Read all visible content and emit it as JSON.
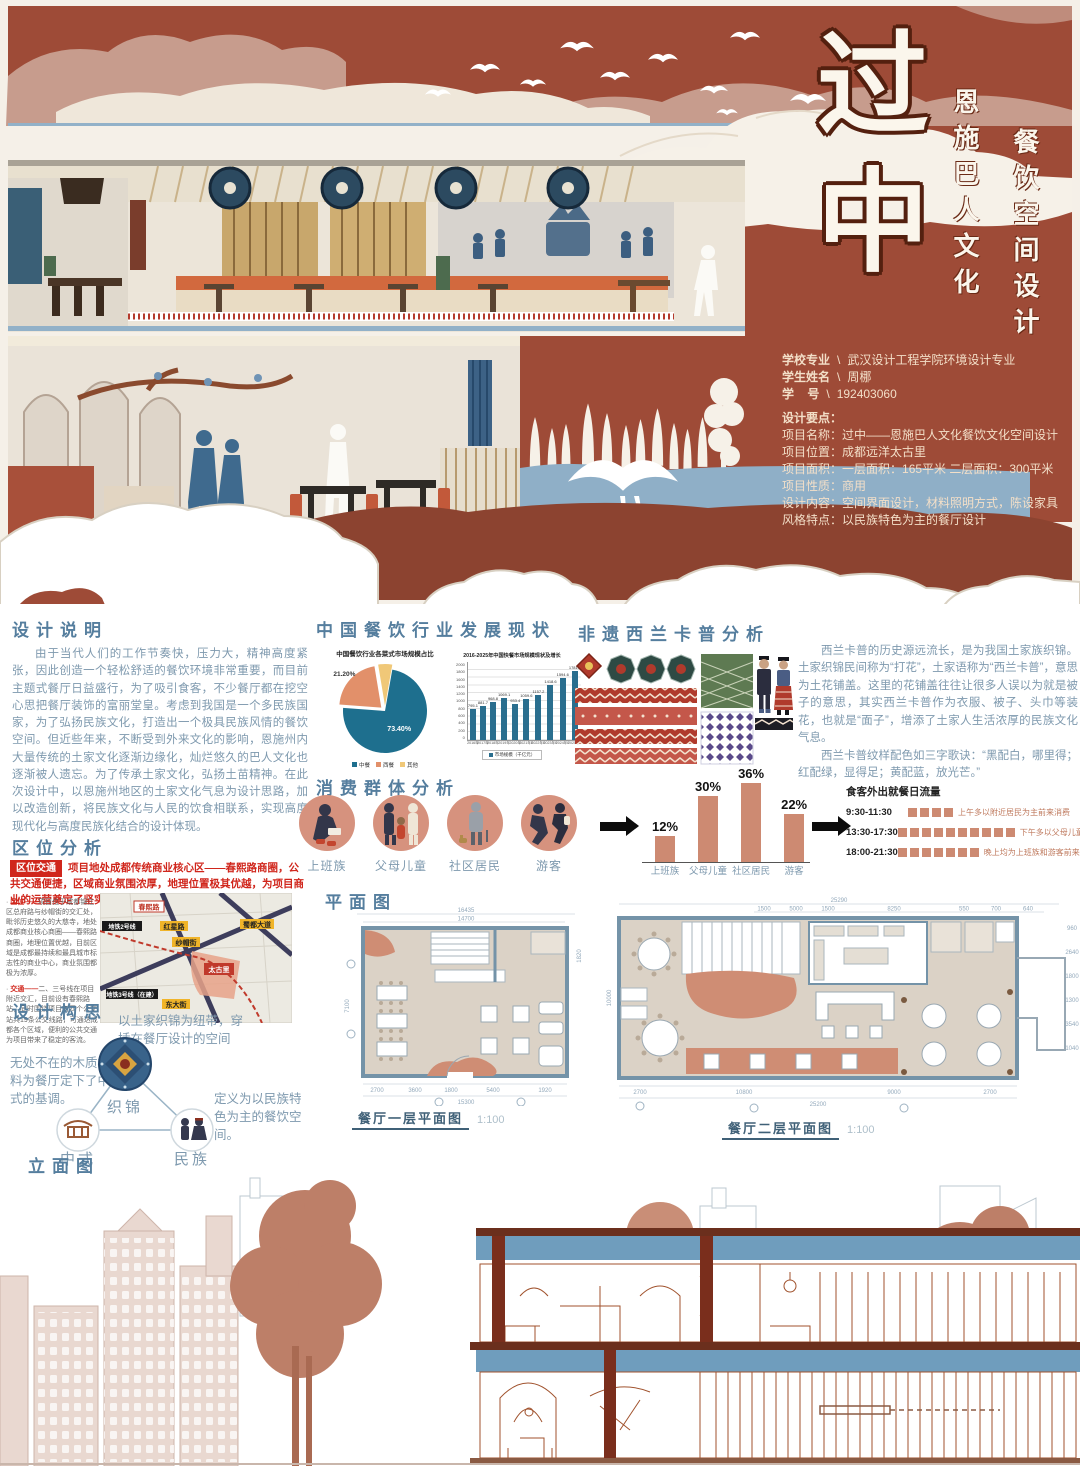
{
  "hero": {
    "title_main_char1": "过",
    "title_main_char2": "中",
    "title_col_1": "恩施巴人文化",
    "title_col_2": "餐饮空间设计",
    "info_sep": "\\",
    "info_rows": [
      {
        "label": "学校专业",
        "value": "武汉设计工程学院环境设计专业"
      },
      {
        "label": "学生姓名",
        "value": "周梛"
      },
      {
        "label": "学    号",
        "value": "192403060"
      }
    ],
    "points_title": "设计要点：",
    "points": [
      {
        "label": "项目名称：",
        "value": "过中——恩施巴人文化餐饮文化空间设计"
      },
      {
        "label": "项目位置：",
        "value": "成都远洋太古里"
      },
      {
        "label": "项目面积：",
        "value": "一层面积：165平米  二层面积：300平米"
      },
      {
        "label": "项目性质：",
        "value": "商用"
      },
      {
        "label": "设计内容：",
        "value": "空间界面设计，材料照明方式，陈设家具"
      },
      {
        "label": "风格特点：",
        "value": "以民族特色为主的餐厅设计"
      }
    ],
    "icons": [
      "crane-flock-icon",
      "cloud-icon",
      "cypress-tree-icon",
      "flying-crane-icon"
    ]
  },
  "design_note": {
    "title": "设计说明",
    "body": "由于当代人们的工作节奏快，压力大，精神高度紧张，因此创造一个轻松舒适的餐饮环境非常重要，而目前主题式餐厅日益盛行，为了吸引食客，不少餐厅都在挖空心思把餐厅装饰的富丽堂皇。考虑到我国是一个多民族国家，为了弘扬民族文化，打造出一个极具民族风情的餐饮空间。但近些年来，不断受到外来文化的影响，恩施州内大量传统的土家文化逐渐边缘化，灿烂悠久的巴人文化也逐渐被人遗忘。为了传承土家文化，弘扬土苗精神。在此次设计中，以恩施州地区的土家文化气息为设计思路，加以改造创新，将民族文化与人民的饮食相联系，实现高度现代化与高度民族化结合的设计体现。"
  },
  "location": {
    "title": "区位分析",
    "badge": "区位交通",
    "headline": "项目地处成都传统商业核心区——春熙路商圈，公共交通便捷，区域商业氛围浓厚，地理位置极其优越，为项目商业的运营奠定了坚实基础。",
    "bullets": [
      {
        "lead": "区位——",
        "text": "项目位于成都锦江区总府路与纱帽街的交汇处，毗邻历史悠久的大慈寺，地处成都商业核心商圈——春熙路商圈，地理位置优越，目前区域是成都最持续和最具城市标志性的商业中心，商业氛围都极为浓厚。"
      },
      {
        "lead": "交通——",
        "text": "二、三号线在项目附近交汇，目前设有春熙路站，同时围绕项目有四个公交站共19条公交线路，可通达成都各个区域，便利的公共交通为项目带来了稳定的客流。"
      }
    ],
    "map": {
      "road_labels": [
        "春熙路",
        "红星路",
        "纱帽街",
        "蜀都大道",
        "东大街"
      ],
      "site_label": "太古里",
      "metro_labels": [
        "地铁2号线",
        "地铁3号线（在建）"
      ]
    }
  },
  "concept": {
    "title": "设计构思",
    "note_top": "以土家织锦为纽带，穿插在餐厅设计的空间中。",
    "note_left": "无处不在的木质材料为餐厅定下了中式的基调。",
    "note_right": "定义为以民族特色为主的餐饮空间。",
    "nodes": [
      {
        "label": "织锦",
        "icon": "brocade-medallion-icon"
      },
      {
        "label": "中式",
        "icon": "chinese-building-icon"
      },
      {
        "label": "民族",
        "icon": "ethnic-couple-icon"
      }
    ]
  },
  "industry": {
    "title": "中国餐饮行业发展现状"
  },
  "xilankapu": {
    "title": "非遗西兰卡普分析",
    "para1": "西兰卡普的历史源远流长，是为我国土家族织锦。土家织锦民间称为“打花”，土家语称为“西兰卡普”，意思为土花铺盖。这里的花铺盖往往让很多人误以为就是被子的意思，其实西兰卡普作为衣服、被子、头巾等装花，也就是“面子”，增添了土家人生活浓厚的民族文化气息。",
    "para2": "西兰卡普纹样配色如三字歌诀：“黑配白，哪里得；红配绿，显得足；黄配蓝，放光芒。”",
    "icons": [
      "brocade-pattern-swatch-icon",
      "tujia-costume-figures-icon"
    ]
  },
  "consumers": {
    "title": "消费群体分析",
    "groups": [
      {
        "label": "上班族",
        "icon": "office-worker-icon"
      },
      {
        "label": "父母儿童",
        "icon": "parents-children-icon"
      },
      {
        "label": "社区居民",
        "icon": "community-resident-icon"
      },
      {
        "label": "游客",
        "icon": "tourist-icon"
      }
    ]
  },
  "plans": {
    "title": "平面图",
    "plan1": {
      "caption": "餐厅一层平面图",
      "scale": "1:100",
      "dim_top_total": "16435",
      "dim_top_inner": "14700",
      "dims_bottom": [
        "2700",
        "3600",
        "1800",
        "5400",
        "1920"
      ],
      "dim_bottom_total": "15300",
      "dim_left": "7100",
      "dim_right": "1820"
    },
    "plan2": {
      "caption": "餐厅二层平面图",
      "scale": "1:100",
      "dim_top_total": "25290",
      "dims_top": [
        "1500",
        "5000",
        "1500",
        "8250",
        "550",
        "700",
        "640"
      ],
      "dims_bottom": [
        "2700",
        "10800",
        "9000",
        "2700"
      ],
      "dim_bottom_total": "25200",
      "dim_left": "10000",
      "dims_right": [
        "960",
        "2640",
        "1800",
        "1300",
        "3540",
        "1040"
      ]
    }
  },
  "elevation": {
    "title": "立面图"
  },
  "chart_data": [
    {
      "id": "cuisine_pie",
      "type": "pie",
      "title": "中国餐饮行业各菜式市场规模占比",
      "labels": [
        "中餐",
        "西餐",
        "其他"
      ],
      "values": [
        73.4,
        21.2,
        5.4
      ],
      "value_labels": [
        "73.40%",
        "21.20%",
        "5.40%"
      ],
      "colors": [
        "#1e6f8e",
        "#e2906a",
        "#f0c878"
      ],
      "legend_position": "bottom"
    },
    {
      "id": "fastfood_bar",
      "type": "bar",
      "title": "2016-2025年中国快餐市场规模现状及增长",
      "categories": [
        "2016年",
        "2017年",
        "2018年",
        "2019年",
        "2020年",
        "2021年E",
        "2022年E",
        "2023年E",
        "2024年E",
        "2025年E"
      ],
      "values": [
        795.1,
        881.7,
        968.8,
        1069.1,
        933.4,
        1059.6,
        1157.2,
        1418.6,
        1594.6,
        1781.4
      ],
      "ylim": [
        0,
        2000
      ],
      "yticks": [
        0,
        200,
        400,
        600,
        800,
        1000,
        1200,
        1400,
        1600,
        1800,
        2000
      ],
      "legend": "市场规模（千亿元）",
      "color": "#2a6e8e",
      "grid": true
    },
    {
      "id": "consumer_bar",
      "type": "bar",
      "categories": [
        "上班族",
        "父母儿童",
        "社区居民",
        "游客"
      ],
      "values": [
        12,
        30,
        36,
        22
      ],
      "value_labels": [
        "12%",
        "30%",
        "36%",
        "22%"
      ],
      "ylim": [
        0,
        40
      ],
      "color": "#cd8a72"
    },
    {
      "id": "visit_flow",
      "type": "table",
      "title": "食客外出就餐日流量",
      "rows": [
        {
          "time": "9:30-11:30",
          "units": 4,
          "desc": "上午多以附近居民为主前来消费"
        },
        {
          "time": "13:30-17:30",
          "units": 10,
          "desc": "下午多以父母儿童和游客"
        },
        {
          "time": "18:00-21:30",
          "units": 7,
          "desc": "晚上均为上班族和游客前来消费"
        }
      ]
    }
  ]
}
